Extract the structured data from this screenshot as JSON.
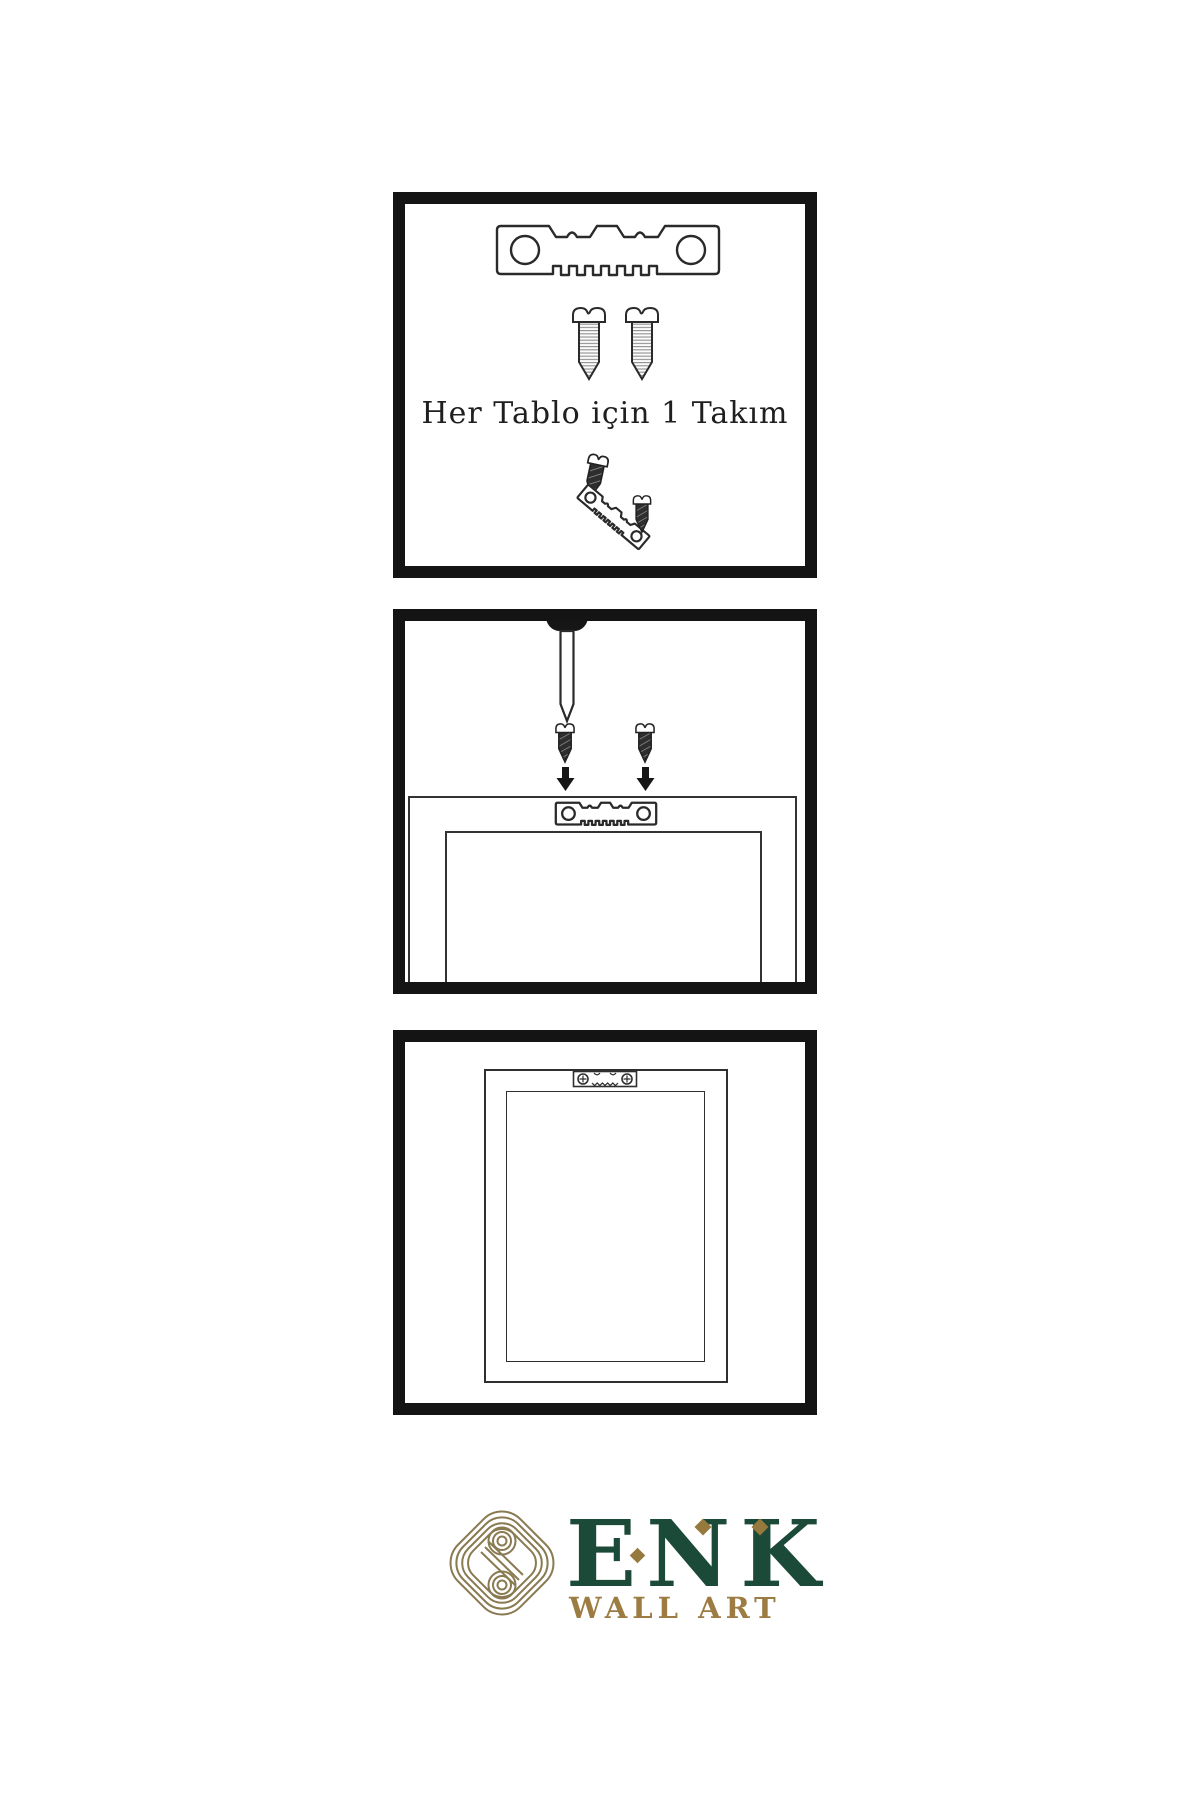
{
  "colors": {
    "background": "#ffffff",
    "line_art": "#2a2a2a",
    "panel_border": "#141414",
    "logo_green": "#1c4a38",
    "logo_gold": "#9c7c42",
    "knot_gold": "#8a7a52"
  },
  "panels": {
    "kit": {
      "caption": "Her Tablo için 1 Takım",
      "items": [
        "sawtooth-hanger",
        "mounting-screw",
        "mounting-screw",
        "screw-driving-into-hanger",
        "angled-sawtooth-hanger",
        "mounting-screw-small"
      ]
    },
    "mount": {
      "items": [
        "wall-nail",
        "mounting-screw",
        "mounting-screw",
        "down-arrow",
        "down-arrow",
        "frame-back",
        "sawtooth-hanger-on-frame"
      ]
    },
    "hang": {
      "items": [
        "picture-frame-back",
        "inner-panel",
        "installed-sawtooth-hanger"
      ]
    }
  },
  "logo": {
    "wordmark": "ENK",
    "subtitle": "WALL ART",
    "icon": "knot-icon"
  }
}
